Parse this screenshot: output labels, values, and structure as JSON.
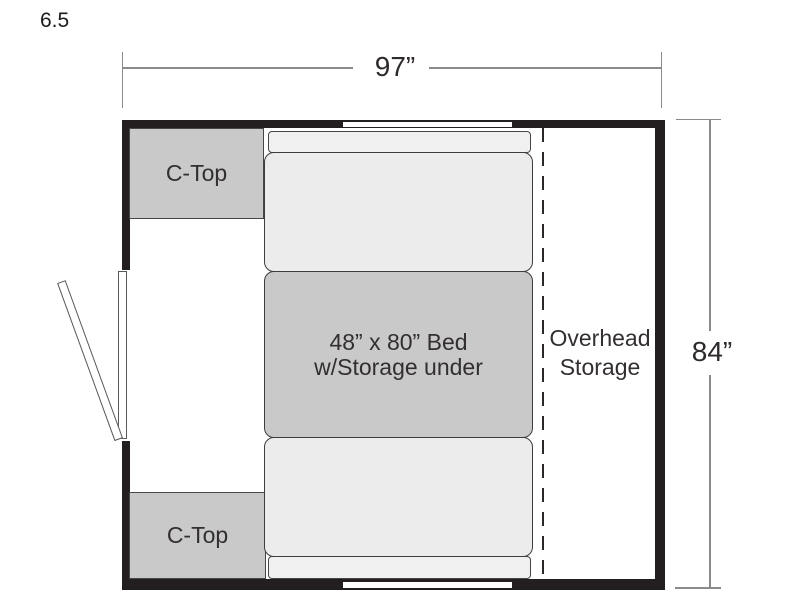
{
  "plan": {
    "model_label": "6.5",
    "width_dimension_label": "97”",
    "height_dimension_label": "84”",
    "counters": [
      {
        "label": "C-Top"
      },
      {
        "label": "C-Top"
      }
    ],
    "bed": {
      "line1": "48” x 80” Bed",
      "line2": "w/Storage under"
    },
    "overhead_storage": {
      "line1": "Overhead",
      "line2": "Storage"
    },
    "features": {
      "door": "entry-door-open-left-wall",
      "windows": [
        "top-wall-window",
        "bottom-wall-window"
      ],
      "overhead_divider": "dashed-line"
    },
    "colors": {
      "wall": "#231f20",
      "counter_fill": "#c9c9ca",
      "bed_fill": "#c9c9ca",
      "cushion_fill": "#ececec",
      "strip_fill": "#f0f0f0",
      "dimension_line": "#8a8a8a",
      "text": "#332f30",
      "background": "#ffffff"
    }
  }
}
